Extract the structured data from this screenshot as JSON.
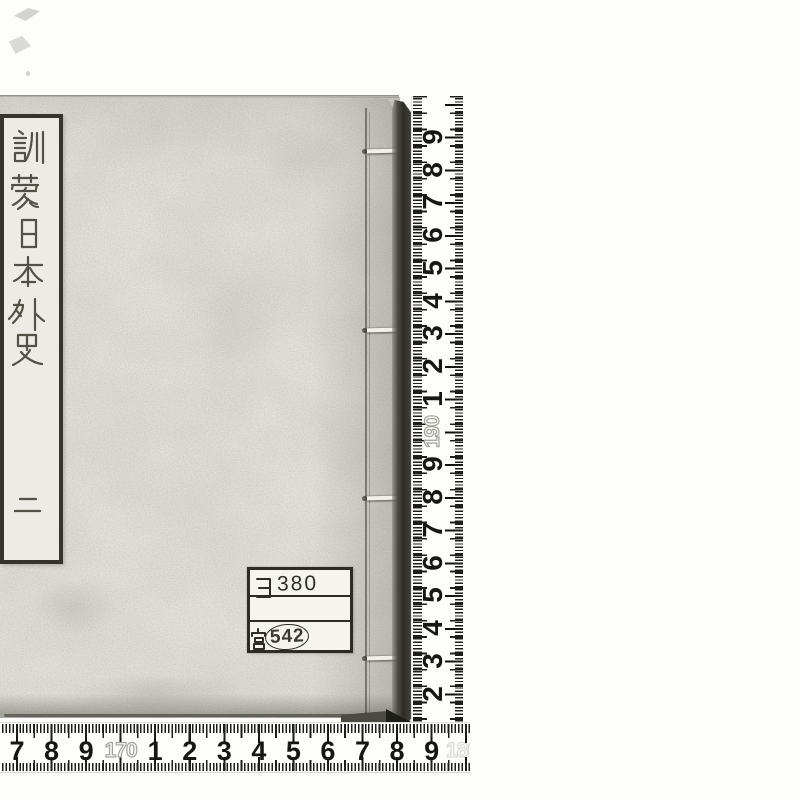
{
  "book": {
    "title_slip": {
      "title": "訓蒙日本外史",
      "volume": "二"
    },
    "library_label": {
      "kana": "ヨ",
      "number": "380",
      "owner": "宮",
      "stamp_number": "542"
    }
  },
  "rulers": {
    "vertical": {
      "labels": [
        "9",
        "8",
        "7",
        "6",
        "5",
        "4",
        "3",
        "2",
        "1",
        "190",
        "9",
        "8",
        "7",
        "6",
        "5",
        "4",
        "3",
        "2"
      ],
      "decimeter_label": "190"
    },
    "horizontal": {
      "labels": [
        "7",
        "8",
        "9",
        "170",
        "1",
        "2",
        "3",
        "4",
        "5",
        "6",
        "7",
        "8",
        "9"
      ],
      "decimeter_label": "170",
      "end_label": "180"
    }
  },
  "colors": {
    "paper": "#e2e1dc",
    "slip": "#edebe5",
    "ink": "#45433a",
    "ruler_ink": "#161616",
    "edge_shadow": "#2d2c27",
    "background": "#fdfdfc"
  }
}
